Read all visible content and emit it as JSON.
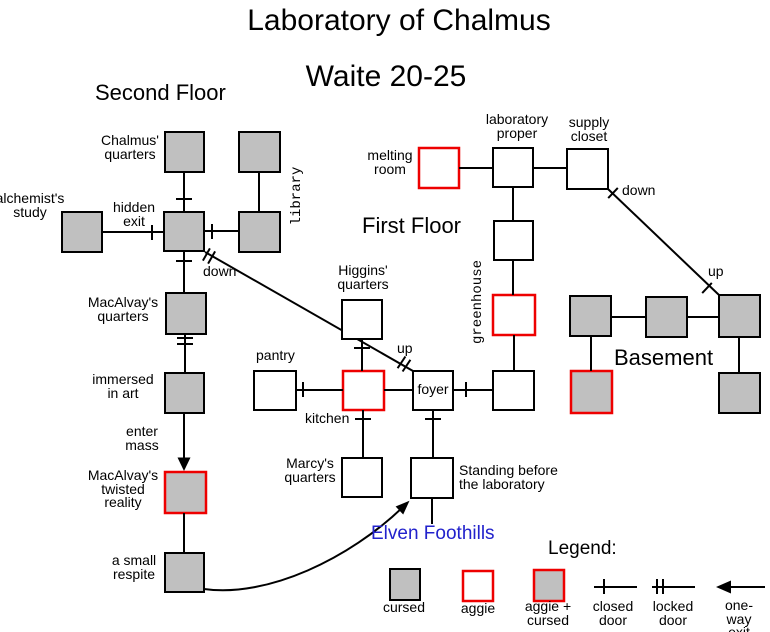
{
  "title": {
    "main": "Laboratory of Chalmus",
    "sub": "Waite 20-25"
  },
  "headings": {
    "second_floor": "Second Floor",
    "first_floor": "First Floor",
    "basement": "Basement",
    "legend": "Legend:",
    "area_exit": "Elven Foothills"
  },
  "rooms": {
    "chalmus": {
      "label": "Chalmus'\nquarters",
      "type": "cursed"
    },
    "library": {
      "label": "library",
      "type": "cursed"
    },
    "alchemists": {
      "label": "alchemist's\nstudy",
      "type": "cursed"
    },
    "macalvay": {
      "label": "MacAlvay's\nquarters",
      "type": "cursed"
    },
    "immersed": {
      "label": "immersed\nin art",
      "type": "cursed"
    },
    "twisted": {
      "label": "MacAlvay's\ntwisted\nreality",
      "type": "aggie + cursed"
    },
    "respite": {
      "label": "a small\nrespite",
      "type": "cursed"
    },
    "melting": {
      "label": "melting\nroom",
      "type": "aggie"
    },
    "laboratory": {
      "label": "laboratory\nproper",
      "type": "normal"
    },
    "supply": {
      "label": "supply\ncloset",
      "type": "normal"
    },
    "greenhouse": {
      "label": "greenhouse",
      "type": "aggie"
    },
    "higgins": {
      "label": "Higgins'\nquarters",
      "type": "normal"
    },
    "pantry": {
      "label": "pantry",
      "type": "normal"
    },
    "kitchen": {
      "label": "kitchen",
      "type": "aggie"
    },
    "foyer": {
      "label": "foyer",
      "type": "normal"
    },
    "marcy": {
      "label": "Marcy's\nquarters",
      "type": "normal"
    },
    "standing": {
      "label": "Standing before\nthe laboratory",
      "type": "normal"
    }
  },
  "exits": {
    "hidden": "hidden\nexit",
    "enter_mass": "enter\nmass",
    "down_stairs": "down",
    "up_stairs": "up",
    "down_basement": "down",
    "up_basement": "up"
  },
  "legend": {
    "cursed": "cursed",
    "aggie": "aggie",
    "aggie_cursed": "aggie +\ncursed",
    "closed_door": "closed\ndoor",
    "locked_door": "locked\ndoor",
    "one_way_exit": "one-way\nexit"
  },
  "colors": {
    "cursed_fill": "#c0c0c0",
    "aggie_border": "#ee0000",
    "area_exit_text": "#2222cc",
    "line": "#000000"
  }
}
